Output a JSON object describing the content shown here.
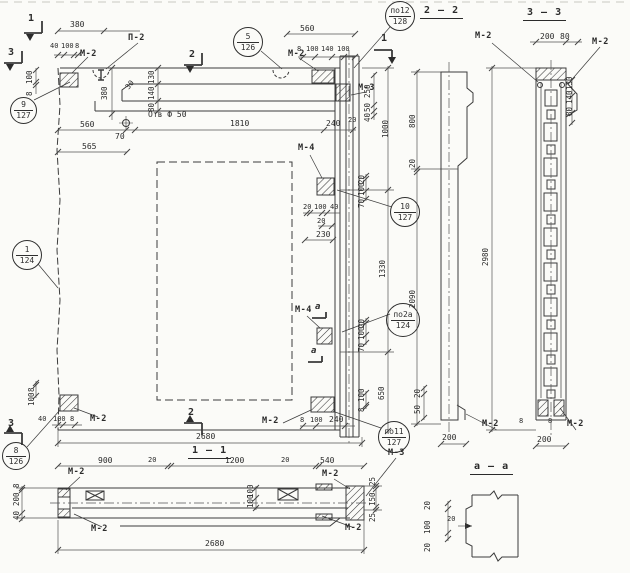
{
  "callouts": [
    {
      "num": "9",
      "sheet": "127"
    },
    {
      "num": "5",
      "sheet": "126"
    },
    {
      "num": "по12",
      "sheet": "128"
    },
    {
      "num": "1",
      "sheet": "124"
    },
    {
      "num": "10",
      "sheet": "127"
    },
    {
      "num": "по2а",
      "sheet": "124"
    },
    {
      "num": "8",
      "sheet": "126"
    },
    {
      "num": "по11",
      "sheet": "127"
    }
  ],
  "marks": {
    "m2": "М-2",
    "m3": "М-3",
    "m4": "М-4",
    "p2": "П-2"
  },
  "sections": {
    "s11": "1 — 1",
    "s22": "2 — 2",
    "s33": "3 — 3",
    "saa": "а — а"
  },
  "markers": {
    "n1": "1",
    "n2": "2",
    "n3": "3",
    "a": "а"
  },
  "notes": {
    "hole": "Отв Ф 50"
  },
  "dims": {
    "v8": "8",
    "v20": "20",
    "v25": "25",
    "v30": "30",
    "v40": "40",
    "v50": "50",
    "v70": "70",
    "v80": "80",
    "v100": "100",
    "v130": "130",
    "v140": "140",
    "v150": "150",
    "v200": "200",
    "v230": "230",
    "v240": "240",
    "v250": "250",
    "v380": "380",
    "v540": "540",
    "v560": "560",
    "v565": "565",
    "v650": "650",
    "v800": "800",
    "v900": "900",
    "v1000": "1000",
    "v1200": "1200",
    "v1330": "1330",
    "v1810": "1810",
    "v2090": "2090",
    "v2680": "2680",
    "v2980": "2980"
  }
}
